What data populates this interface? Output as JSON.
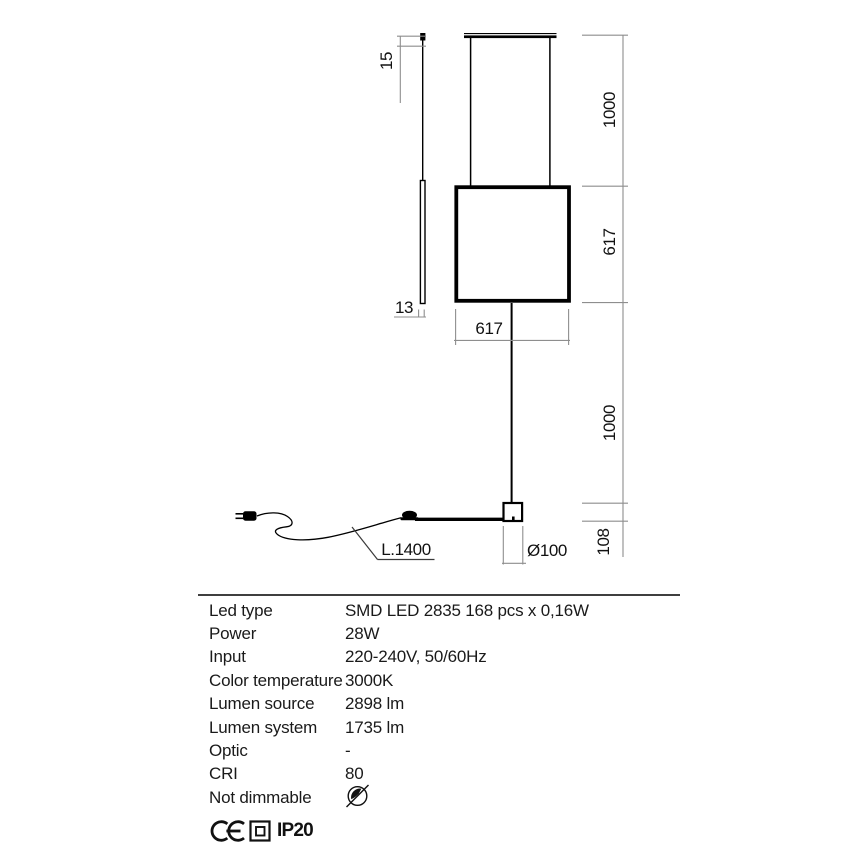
{
  "diagram": {
    "dimensions": {
      "tip_height": "15",
      "profile_width": "13",
      "frame_width": "617",
      "frame_height": "617",
      "suspension_drop": "1000",
      "stem_height": "1000",
      "base_height": "108",
      "base_diameter": "Ø100",
      "cable_length": "L.1400"
    },
    "icons": [
      "plug-icon",
      "switch-icon"
    ]
  },
  "specs": {
    "rows": [
      {
        "label": "Led type",
        "value": "SMD LED 2835 168 pcs x 0,16W"
      },
      {
        "label": "Power",
        "value": "28W"
      },
      {
        "label": "Input",
        "value": "220-240V, 50/60Hz"
      },
      {
        "label": "Color temperature",
        "value": "3000K"
      },
      {
        "label": "Lumen source",
        "value": "2898 lm"
      },
      {
        "label": "Lumen system",
        "value": "1735 lm"
      },
      {
        "label": "Optic",
        "value": "-"
      },
      {
        "label": "CRI",
        "value": "80"
      },
      {
        "label": "Not dimmable",
        "value": ""
      }
    ]
  },
  "footer": {
    "ip_rating": "IP20",
    "icons": [
      "ce-mark-icon",
      "class-ii-insulation-icon",
      "not-dimmable-icon"
    ]
  },
  "colors": {
    "object_line": "#000000",
    "dimension_line": "#8e8e8e",
    "text": "#1a1a1a",
    "background": "#ffffff"
  }
}
